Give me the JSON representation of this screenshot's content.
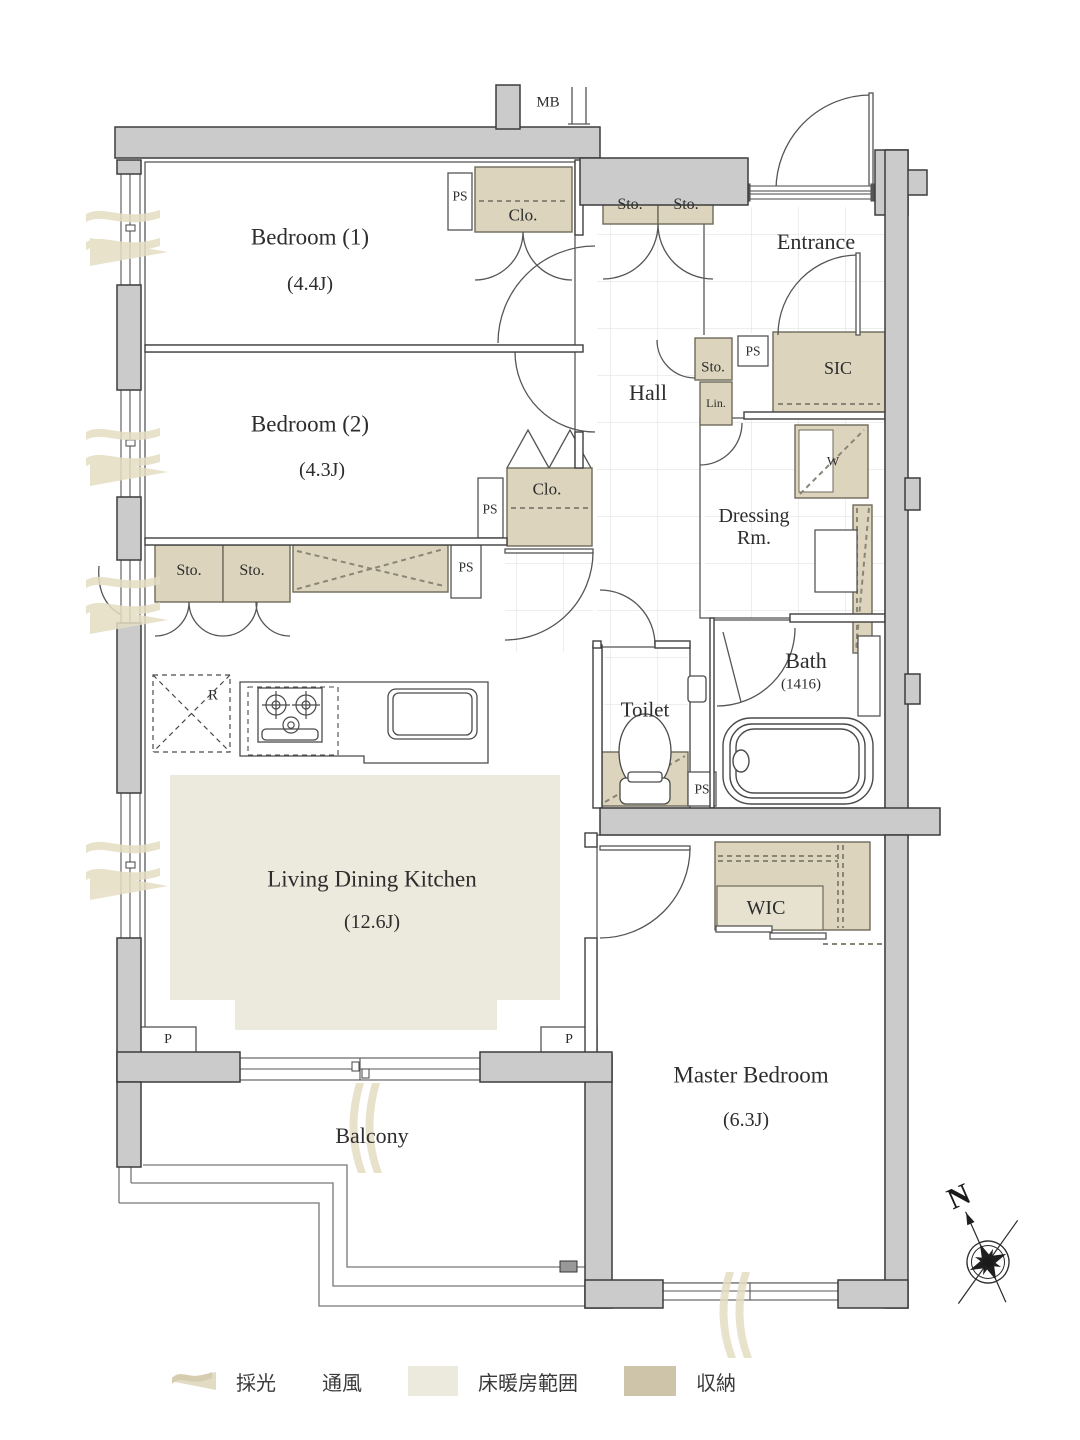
{
  "rooms": {
    "bedroom1": {
      "name": "Bedroom (1)",
      "size": "(4.4J)"
    },
    "bedroom2": {
      "name": "Bedroom (2)",
      "size": "(4.3J)"
    },
    "ldk": {
      "name": "Living Dining Kitchen",
      "size": "(12.6J)"
    },
    "master": {
      "name": "Master Bedroom",
      "size": "(6.3J)"
    },
    "bath": {
      "name": "Bath",
      "size": "(1416)"
    },
    "toilet": {
      "name": "Toilet"
    },
    "hall": {
      "name": "Hall"
    },
    "entrance": {
      "name": "Entrance"
    },
    "dressing": {
      "name_line1": "Dressing",
      "name_line2": "Rm."
    },
    "balcony": {
      "name": "Balcony"
    },
    "wic": {
      "name": "WIC"
    },
    "sic": {
      "name": "SIC"
    }
  },
  "fixtures": {
    "closet": "Clo.",
    "storage": "Sto.",
    "pipe_space": "PS",
    "linen": "Lin.",
    "washer": "W",
    "refrigerator": "R",
    "pipe": "P",
    "meter_box": "MB"
  },
  "compass": {
    "north": "N"
  },
  "legend": {
    "items": [
      {
        "name": "daylight",
        "label": "採光"
      },
      {
        "name": "ventilation",
        "label": "通風"
      },
      {
        "name": "floor_heating",
        "label": "床暖房範囲"
      },
      {
        "name": "storage",
        "label": "収納"
      }
    ]
  },
  "colors": {
    "wall_fill": "#cbcbcb",
    "storage_fill": "#dcd4bd",
    "floor_heating_fill": "#ece9dd",
    "symbol_fill": "#e5ddc3",
    "legend_storage_fill": "#cdc4a9",
    "line": "#3d3d3d"
  }
}
